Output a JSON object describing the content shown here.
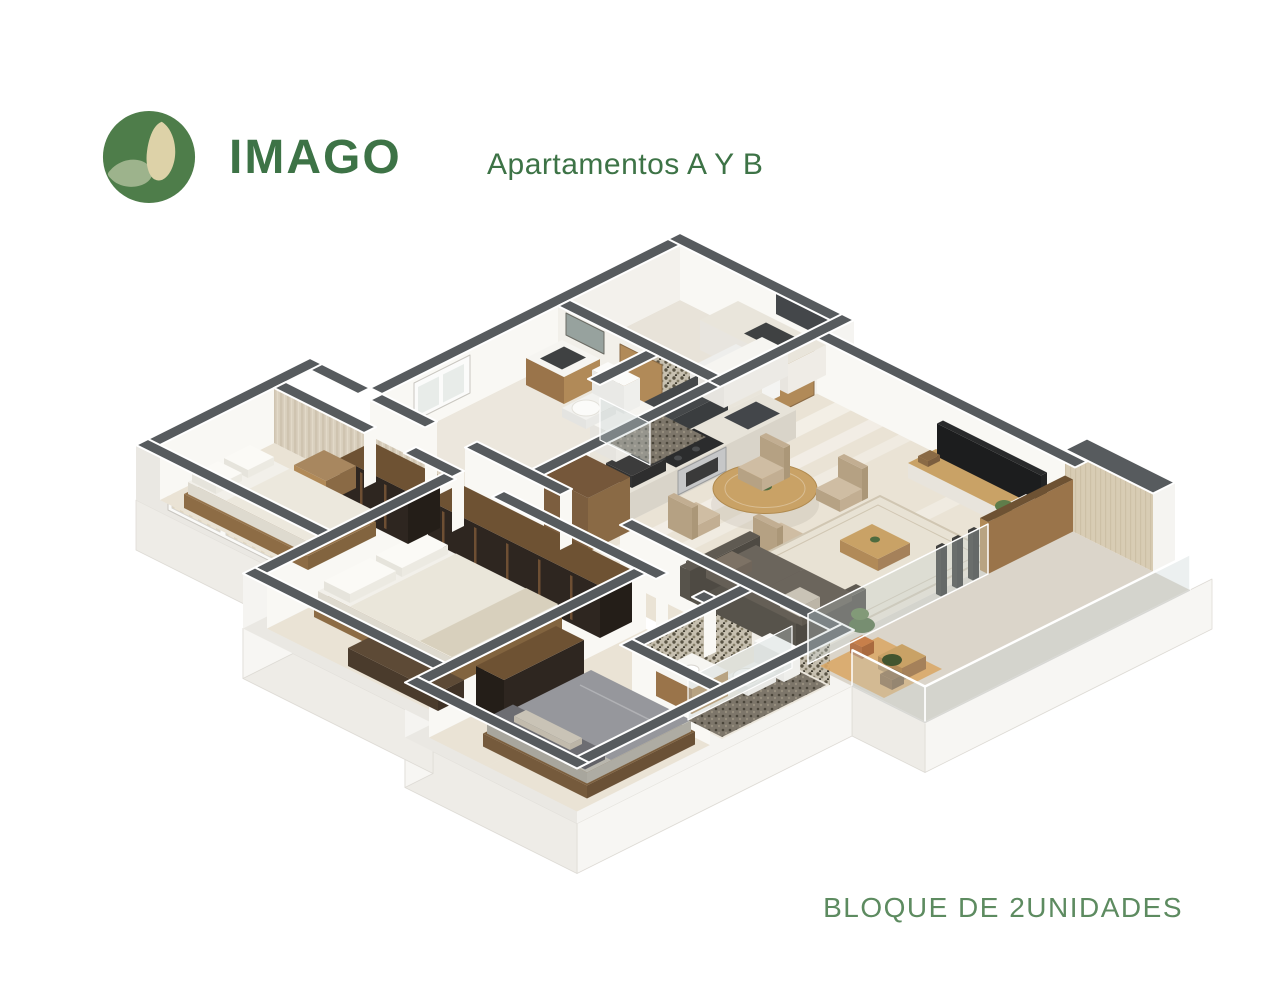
{
  "header": {
    "brand": "IMAGO",
    "subtitle": "Apartamentos A Y B"
  },
  "footer": {
    "caption": "BLOQUE DE 2UNIDADES"
  },
  "logo": {
    "bg": "#4e7d4a",
    "leaf": "#9db38c",
    "seed": "#ddd2a8"
  },
  "palette": {
    "brandGreen": "#3d7346",
    "captionGreen": "#5d8b60",
    "wallTop": "#575b5e",
    "wallEdge": "#ffffff",
    "extFaceR": "#f5f4f1",
    "extFaceL": "#eae8e3",
    "plinthR": "#f7f6f3",
    "plinthL": "#eeece7",
    "plinthLine": "#dedbd5",
    "innerFace": "#f9f8f4",
    "innerFaceSoft": "#f3f1ec",
    "floor": "#eae3d5",
    "floorBath": "#ece7dd",
    "floorBalcony": "#dbd5ca",
    "floorLaundry": "#e8e3d9",
    "wood": "#b18a58",
    "woodMid": "#9a744a",
    "woodDark": "#6e5233",
    "woodDeep": "#8a6a45",
    "wardrobe": "#2e2620",
    "wardrobeSide": "#241e18",
    "wardrobeTrim": "#6e4f33",
    "marble": "#e9e5db",
    "counter": "#e7e3d9",
    "steel": "#c6c7c8",
    "dark": "#44474a",
    "darker": "#2b2c2d",
    "white": "#f4f4f2",
    "bedFrame": "#96744c",
    "bedFrameDark": "#7c5f3e",
    "mattress": "#f2f0ea",
    "duvet": "#eae6da",
    "pillow": "#fbfaf6",
    "duvetGray": "#96979c",
    "mattGray": "#b9b7ae",
    "pillowDark": "#6d6d72",
    "pillowLight": "#c9c3b6",
    "sofa": "#5f5a52",
    "sofaDark": "#4e4a43",
    "cushion": "#6b655c",
    "rug": "#e8e2d4",
    "rugLine": "#d0c6b2",
    "tableWood": "#c9a266",
    "chair": "#c2ae92",
    "chairTop": "#cfbda3",
    "glass": "rgba(200,212,212,0.34)",
    "glassLine": "#ffffff",
    "mat": "#d9a868",
    "plant": "#4e6b3f",
    "plantLight": "#5f7d4a",
    "pot": "#c77f4a",
    "shadow": "rgba(60,50,40,0.08)"
  }
}
